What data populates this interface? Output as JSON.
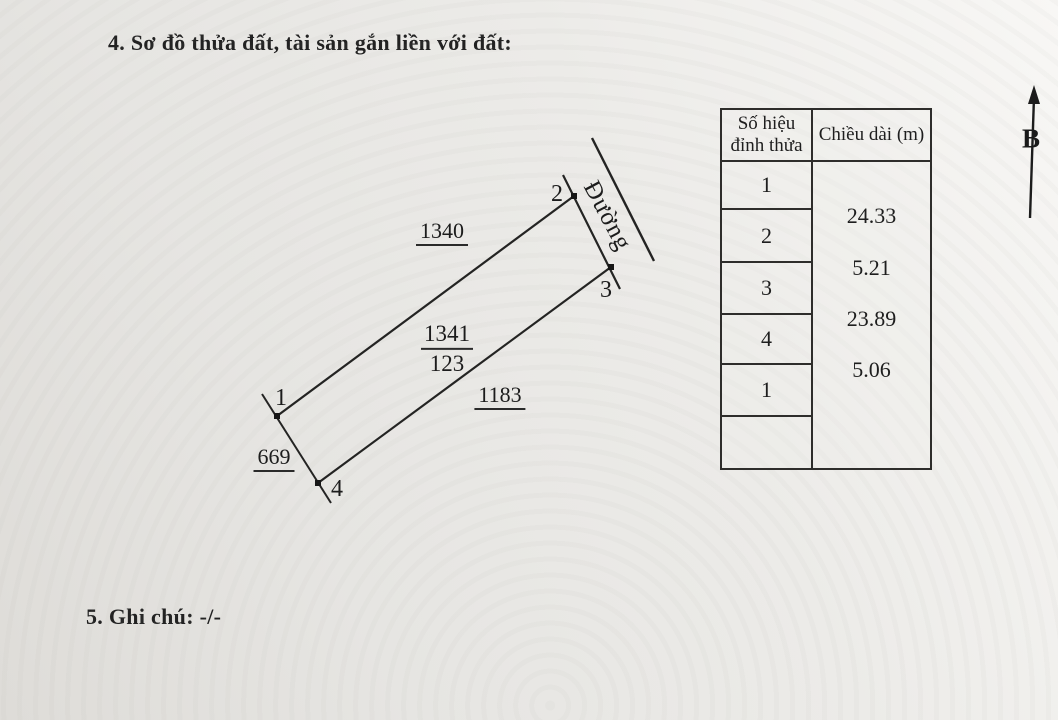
{
  "sections": {
    "plot_diagram_heading": "4. Sơ đồ thửa đất, tài sản gắn liền với đất:",
    "notes_heading": "5. Ghi chú: -/-"
  },
  "diagram": {
    "north_label": "B",
    "road_label": "Đường",
    "vertices": {
      "v1": "1",
      "v2": "2",
      "v3": "3",
      "v4": "4"
    },
    "parcel_number": "1341",
    "parcel_sub_number": "123",
    "adjacent_parcel_top": "1340",
    "adjacent_parcel_right": "1183",
    "adjacent_parcel_left": "669"
  },
  "table": {
    "col1_header": "Số hiệu\nđỉnh thửa",
    "col2_header": "Chiều dài (m)",
    "vertex_numbers": [
      "1",
      "2",
      "3",
      "4",
      "1",
      ""
    ],
    "lengths": [
      "24.33",
      "5.21",
      "23.89",
      "5.06"
    ]
  },
  "colors": {
    "ink": "#1e1e1e",
    "paper": "#eceae7"
  }
}
